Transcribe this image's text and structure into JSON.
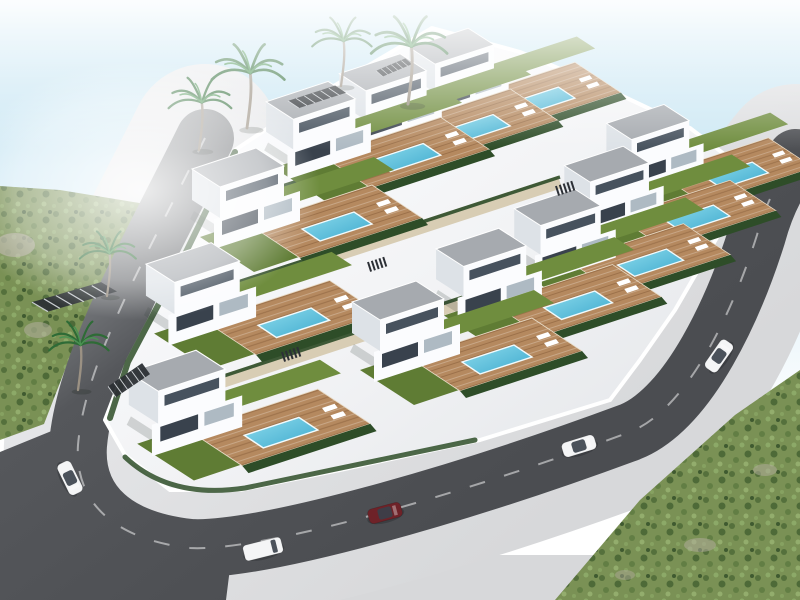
{
  "image_type": "architectural-3d-render",
  "subject": "Aerial bird's-eye 3D rendering of a coastal hillside development of modern white two-storey villas, each with a flat grey roof, timber pool deck, turquoise swimming pool, lawns and hedges, enclosed by a curving ring road with cars, palm trees, and green scrubland at the edges",
  "colors": {
    "sky_top": "#bfe2f1",
    "sky_mid": "#ddeff8",
    "horizon": "#ffffff",
    "road": "#55575b",
    "road_far": "#9a9da0",
    "road_dark": "#4b4d51",
    "sidewalk": "#d7d8da",
    "sidewalk_light": "#e9eaec",
    "curb": "#ffffff",
    "platform": "#f2f3f5",
    "platform_shade": "#e7e9ec",
    "path_tan": "#d8cdb4",
    "lawn": "#6f8d3e",
    "lawn_dark": "#5f7c34",
    "hedge": "#2e4d28",
    "deck_wood": "#b5895f",
    "pool_light": "#8edced",
    "pool_deep": "#3da9cd",
    "roof": "#a6aaaf",
    "wall_light": "#fbfcfe",
    "wall_shade": "#dde2e7",
    "window": "#47525e",
    "opening_dark": "#39424d",
    "scrub": "#7a9155",
    "rock": "#b3ae9f",
    "palm_frond": "#2e6b36",
    "palm_frond_light": "#4a9352",
    "trunk": "#9b9183",
    "car_white": "#f4f5f6",
    "car_red": "#6e2228",
    "lane_line": "rgba(255,255,255,0.5)",
    "pergola_dark": "#2c3035"
  },
  "villas": [
    [
      413,
      42,
      0.92
    ],
    [
      343,
      68,
      0.95
    ],
    [
      270,
      96,
      0.97
    ],
    [
      610,
      118,
      0.9
    ],
    [
      568,
      160,
      0.92
    ],
    [
      196,
      163,
      1.0
    ],
    [
      518,
      203,
      0.94
    ],
    [
      440,
      243,
      0.98
    ],
    [
      150,
      258,
      1.02
    ],
    [
      356,
      296,
      1.0
    ],
    [
      133,
      366,
      1.05
    ]
  ],
  "palms": [
    [
      199,
      150,
      0.95
    ],
    [
      247,
      128,
      1.1
    ],
    [
      341,
      86,
      0.9
    ],
    [
      408,
      104,
      1.15
    ],
    [
      107,
      296,
      0.85
    ],
    [
      78,
      390,
      0.9
    ]
  ],
  "pergolas": [
    [
      288,
      90,
      58,
      20
    ],
    [
      376,
      62,
      36,
      16
    ],
    [
      32,
      288,
      85,
      26
    ],
    [
      108,
      370,
      42,
      30
    ]
  ],
  "stairs": [
    [
      368,
      262
    ],
    [
      282,
      352
    ],
    [
      556,
      186
    ]
  ],
  "cars": [
    {
      "x": 70,
      "y": 478,
      "angle": 64,
      "color": "white",
      "type": "car"
    },
    {
      "x": 263,
      "y": 549,
      "angle": -14,
      "color": "white",
      "type": "van"
    },
    {
      "x": 385,
      "y": 513,
      "angle": -15,
      "color": "darkred",
      "type": "car"
    },
    {
      "x": 579,
      "y": 446,
      "angle": -17,
      "color": "white",
      "type": "car"
    },
    {
      "x": 719,
      "y": 356,
      "angle": -55,
      "color": "white",
      "type": "car"
    }
  ],
  "counts": {
    "villas": 11,
    "pools": 11,
    "palm_trees": 6,
    "cars": 5,
    "pergolas": 4
  }
}
